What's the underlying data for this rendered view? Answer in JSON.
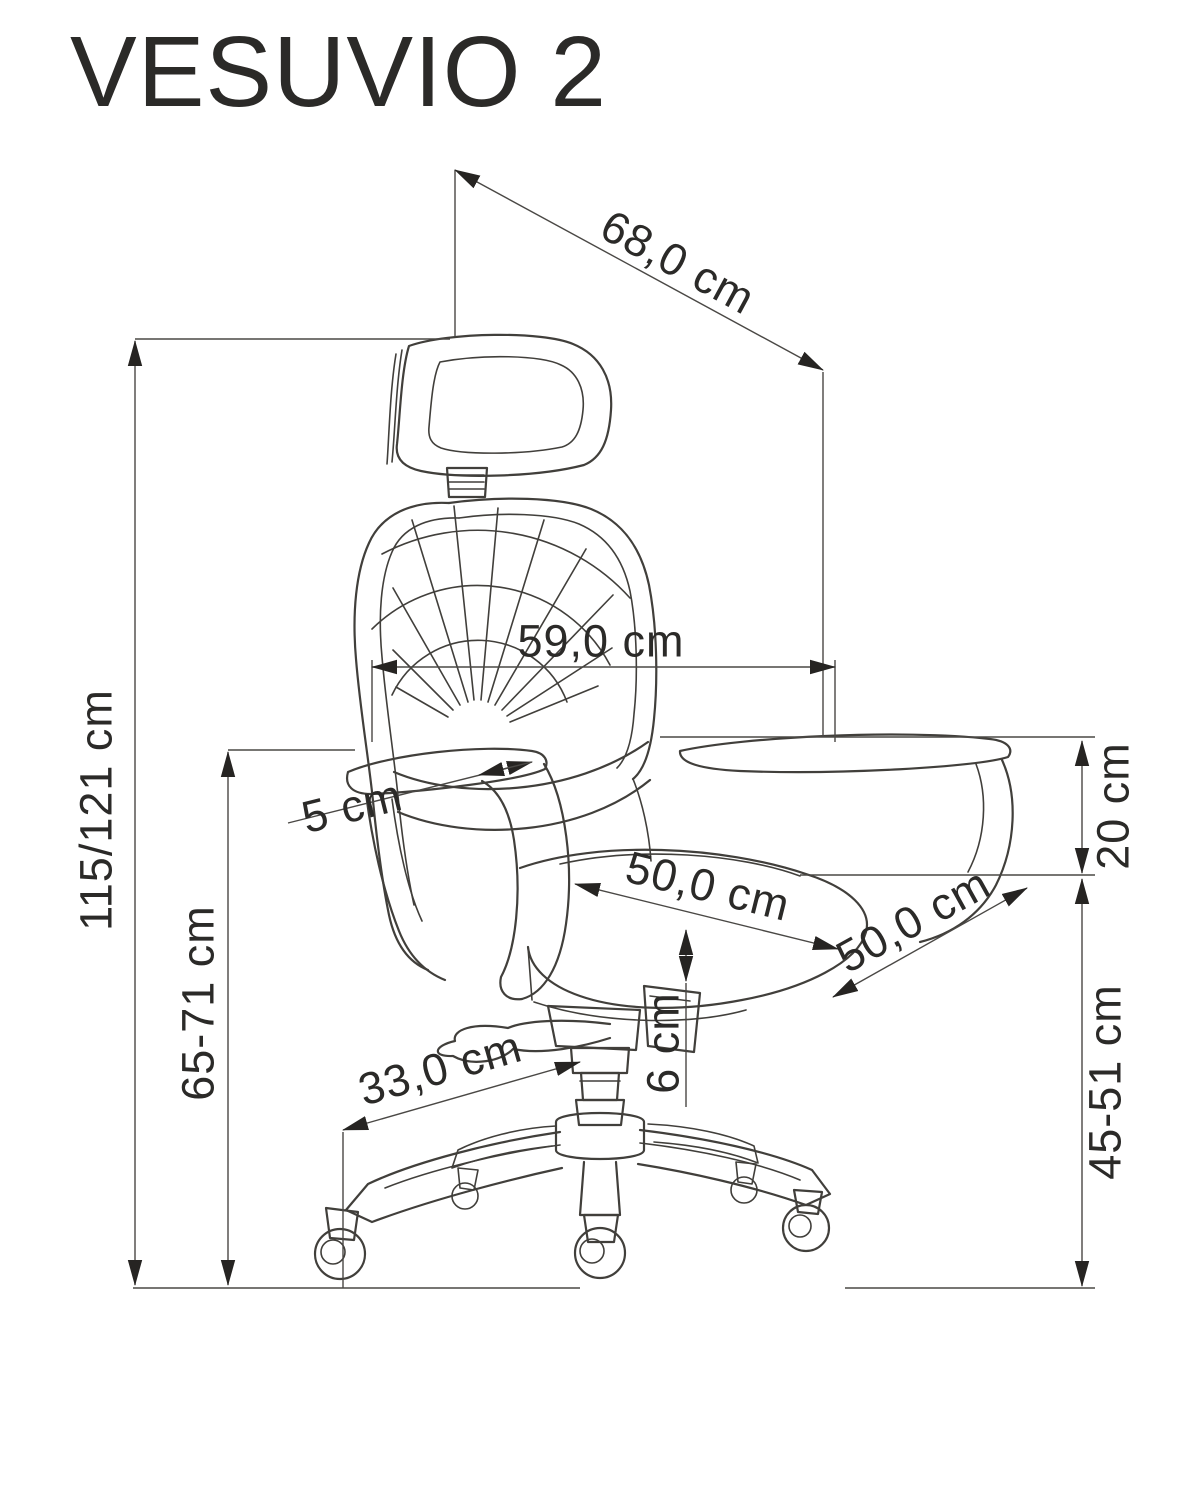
{
  "header": {
    "title": "VESUVIO 2"
  },
  "dimensions": {
    "overall_depth": "68,0 cm",
    "backrest_width": "59,0 cm",
    "armrest_adjustment": "5 cm",
    "seat_depth": "50,0 cm",
    "seat_width": "50,0 cm",
    "armrest_above_seat": "20 cm",
    "seat_height_range": "45-51 cm",
    "overall_height_range": "115/121 cm",
    "armrest_height_range": "65-71 cm",
    "mechanism_gap": "6 cm",
    "base_leg_length": "33,0 cm"
  },
  "colors": {
    "background": "#ffffff",
    "drawing_line": "#413f3b",
    "dimension_line": "#4a4845",
    "arrowhead": "#262422",
    "text": "#2b2a28"
  }
}
